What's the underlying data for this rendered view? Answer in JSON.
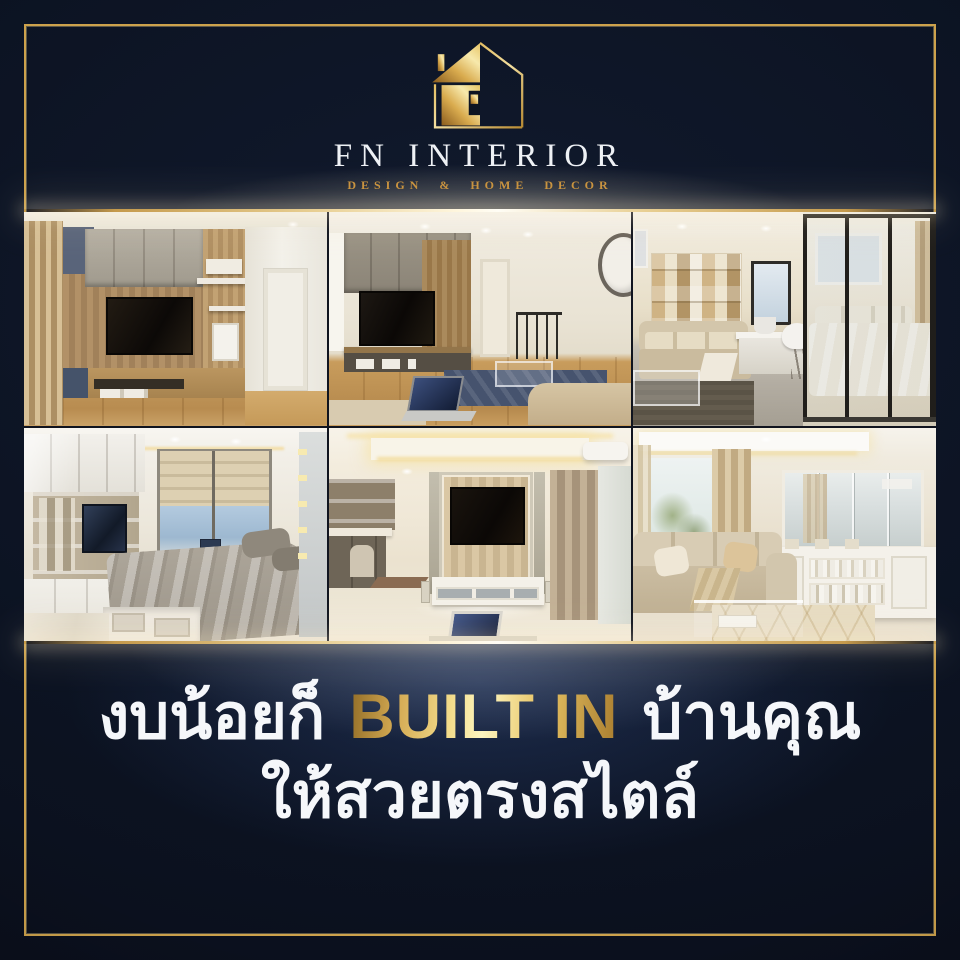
{
  "brand": {
    "name": "FN INTERIOR",
    "tagline": "DESIGN & HOME DECOR",
    "logo_icon": "gold-house-outline-icon"
  },
  "headline": {
    "line1_prefix": "งบน้อยก็",
    "line1_highlight": "BUILT IN",
    "line1_suffix": "บ้านคุณ",
    "line2": "ให้สวยตรงสไตล์"
  },
  "gallery": {
    "photos": [
      {
        "alt": "Living room with wood TV feature wall, grey overhead cabinets, beige curtain and white door"
      },
      {
        "alt": "Living room with taupe built-in TV unit, navy rug, glass coffee table, stair railing, wall clock and laptop"
      },
      {
        "alt": "Condo living area with beige sofa, marble work desk, wood mosaic wall and glass-partitioned bedroom"
      },
      {
        "alt": "Bedroom with glossy white built-ins, TV shelf, roman blinds, sky-view window and taupe bedding"
      },
      {
        "alt": "Classic cream living room with central TV panel, cove-lit ceiling, white console and taupe curtains"
      },
      {
        "alt": "Classic living room with beige sofa, garden-view window, mirrored wall and white display cabinet"
      }
    ]
  },
  "colors": {
    "background_navy": "#0d1422",
    "frame_gold": "#cda24c",
    "tagline_gold": "#c8913c",
    "headline_white": "#f5f7fa",
    "gold_gradient_dark": "#8f6a25",
    "gold_gradient_light": "#fdf6c0"
  }
}
